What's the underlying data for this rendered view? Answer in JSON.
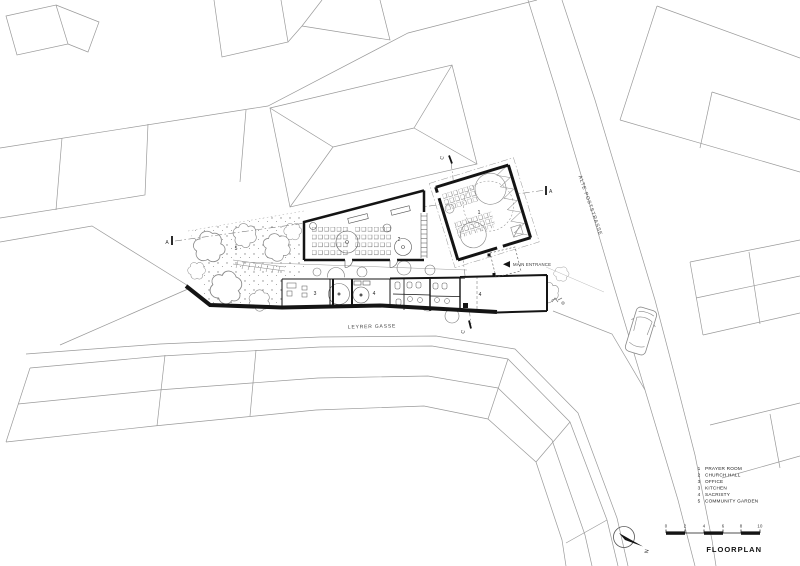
{
  "title": "FLOORPLAN",
  "streets": {
    "south_name": "LEYRER GASSE",
    "east_name": "ALTE POSTSTRASSE"
  },
  "entrance": {
    "label": "MAIN ENTRANCE"
  },
  "north": {
    "label": "N"
  },
  "rooms": {
    "prayer_room": {
      "number": "1",
      "name": "PRAYER ROOM"
    },
    "church_hall": {
      "number": "2",
      "name": "CHURCH HALL"
    },
    "office": {
      "number": "3",
      "name": "OFFICE"
    },
    "kitchen": {
      "number": "4",
      "name": "KITCHEN"
    },
    "sacristy": {
      "number": "4",
      "name": "SACRISTY"
    },
    "community_garden": {
      "number": "5",
      "name": "COMMUNITY GARDEN"
    }
  },
  "legend": {
    "items": [
      {
        "num": "1",
        "label": "PRAYER ROOM"
      },
      {
        "num": "2",
        "label": "CHURCH HALL"
      },
      {
        "num": "3",
        "label": "OFFICE"
      },
      {
        "num": "3",
        "label": "KITCHEN"
      },
      {
        "num": "4",
        "label": "SACRISTY"
      },
      {
        "num": "5",
        "label": "COMMUNITY GARDEN"
      }
    ]
  },
  "scale_bar": {
    "ticks": [
      "0",
      "2",
      "4",
      "6",
      "8",
      "10"
    ]
  },
  "section_markers": {
    "left": "A",
    "right": "A",
    "top": "C",
    "bottom": "C"
  },
  "colors": {
    "wall": "#141414",
    "context_line": "#9a9a9a",
    "text": "#333333",
    "background": "#ffffff"
  }
}
